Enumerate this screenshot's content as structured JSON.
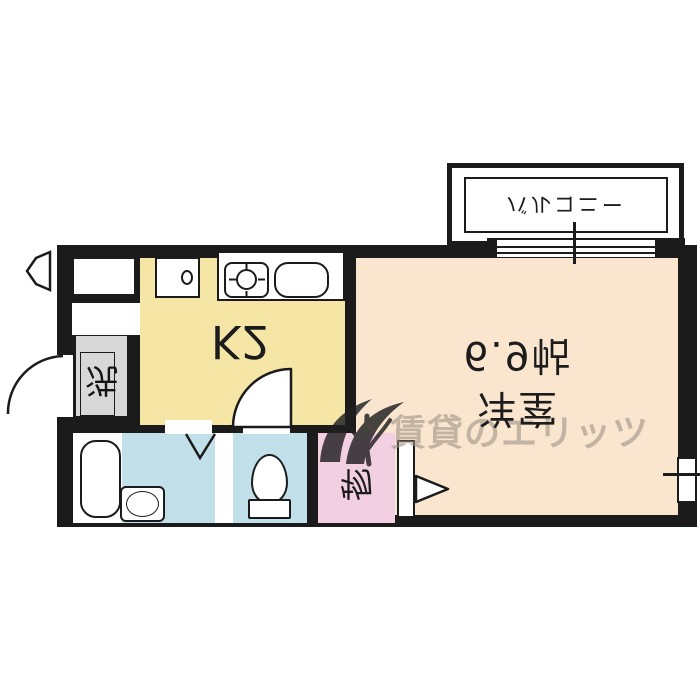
{
  "plan": {
    "balcony_label": "バルコニー",
    "room_name": "洋室",
    "room_area": "6.9帖",
    "kitchen_label": "K2",
    "storage_label": "物",
    "laundry_label": "洗",
    "watermark_text": "賃貸のエリッツ",
    "colors": {
      "wall": "#1b1b1b",
      "room_floor": "#fae6cf",
      "kitchen_floor": "#f5e6a6",
      "bath_floor": "#c2e0e9",
      "toilet_floor": "#c2e0e9",
      "storage_floor": "#f3cfe2",
      "entrance_floor": "#d8d8d8",
      "watermark": "#9e9084"
    }
  }
}
